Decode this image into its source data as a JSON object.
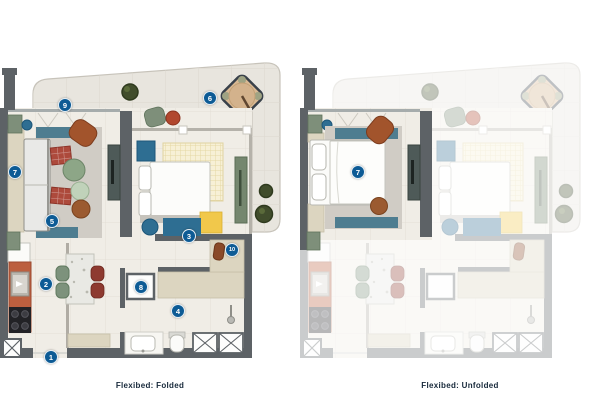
{
  "page": {
    "background": "#ffffff",
    "type": "floorplan-comparison"
  },
  "palette": {
    "marker_bg": "#0d5b95",
    "marker_text": "#ffffff",
    "caption_text": "#16283a",
    "wall_gray": "#5d6266",
    "unit_floor": "#f0ede6",
    "terrace_floor": "#e8e5de",
    "accent_teal": "#2e6e92",
    "accent_terracotta": "#bc5f3f",
    "accent_yellow": "#f1c84b",
    "accent_sage": "#7e8f7a",
    "accent_beige": "#dcd5c0",
    "accent_red": "#ad4a3c"
  },
  "plans": {
    "folded": {
      "caption": "Flexibed: Folded",
      "markers": [
        {
          "n": "1",
          "x": 51,
          "y": 357
        },
        {
          "n": "2",
          "x": 46,
          "y": 284
        },
        {
          "n": "3",
          "x": 189,
          "y": 236
        },
        {
          "n": "4",
          "x": 178,
          "y": 311
        },
        {
          "n": "5",
          "x": 52,
          "y": 221
        },
        {
          "n": "6",
          "x": 210,
          "y": 98
        },
        {
          "n": "7",
          "x": 15,
          "y": 172
        },
        {
          "n": "8",
          "x": 141,
          "y": 287
        },
        {
          "n": "9",
          "x": 65,
          "y": 105
        },
        {
          "n": "10",
          "x": 232,
          "y": 250
        }
      ]
    },
    "unfolded": {
      "caption": "Flexibed: Unfolded",
      "markers": [
        {
          "n": "7",
          "x": 58,
          "y": 172
        }
      ]
    }
  }
}
